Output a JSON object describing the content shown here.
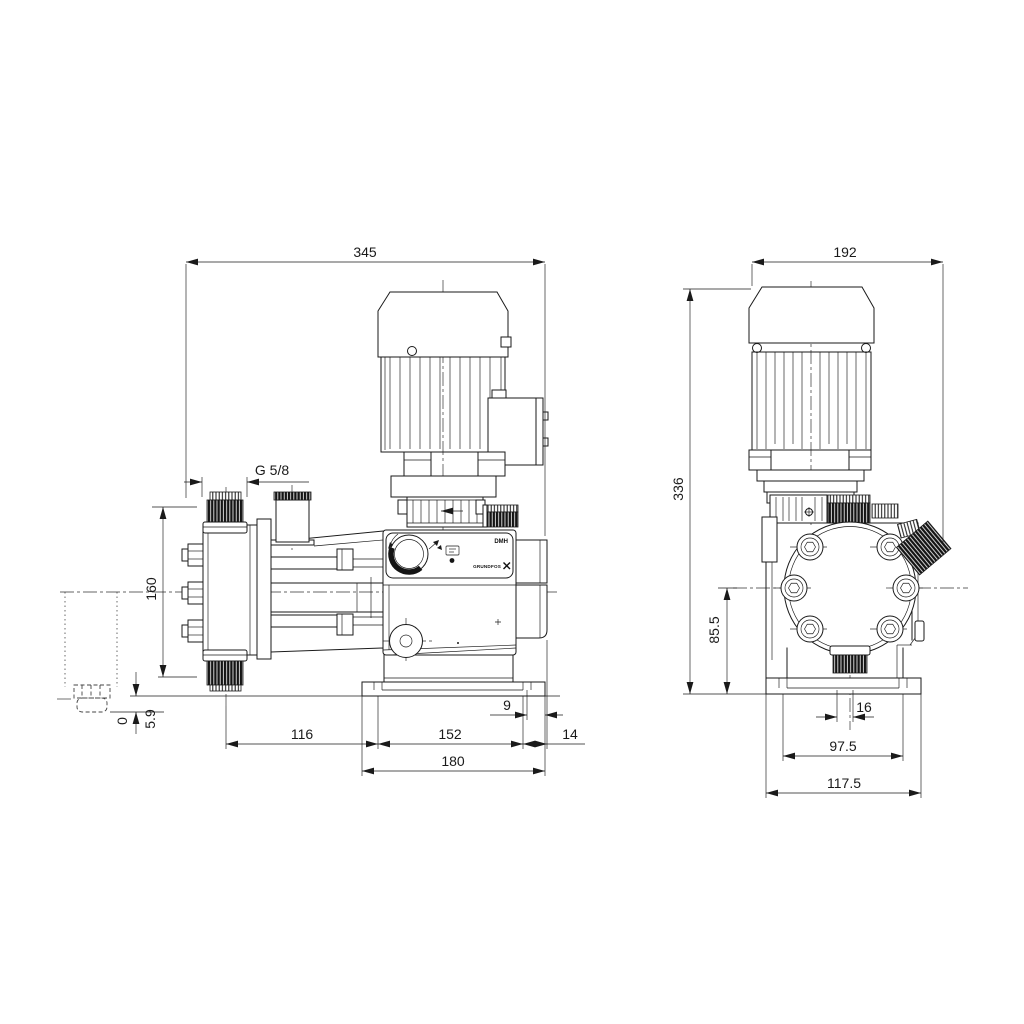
{
  "drawing": {
    "type": "pump dimensional drawing",
    "brand": "GRUNDFOS",
    "model": "DMH"
  },
  "side_view": {
    "dims": {
      "overall_width": "345",
      "thread": "G 5/8",
      "connection_height": "160",
      "datum": "0",
      "clearance": "5.9",
      "head_to_foot": "116",
      "foot_slot_span": "152",
      "slot_to_edge": "9",
      "foot_to_valve_face": "14",
      "base_length": "180"
    }
  },
  "front_view": {
    "dims": {
      "overall_width": "192",
      "overall_height": "336",
      "center_height": "85.5",
      "valve_offset": "16",
      "slot_spacing": "97.5",
      "base_width": "117.5"
    }
  },
  "panel": {
    "model_label": "DMH",
    "logo_text": "GRUNDFOS"
  }
}
